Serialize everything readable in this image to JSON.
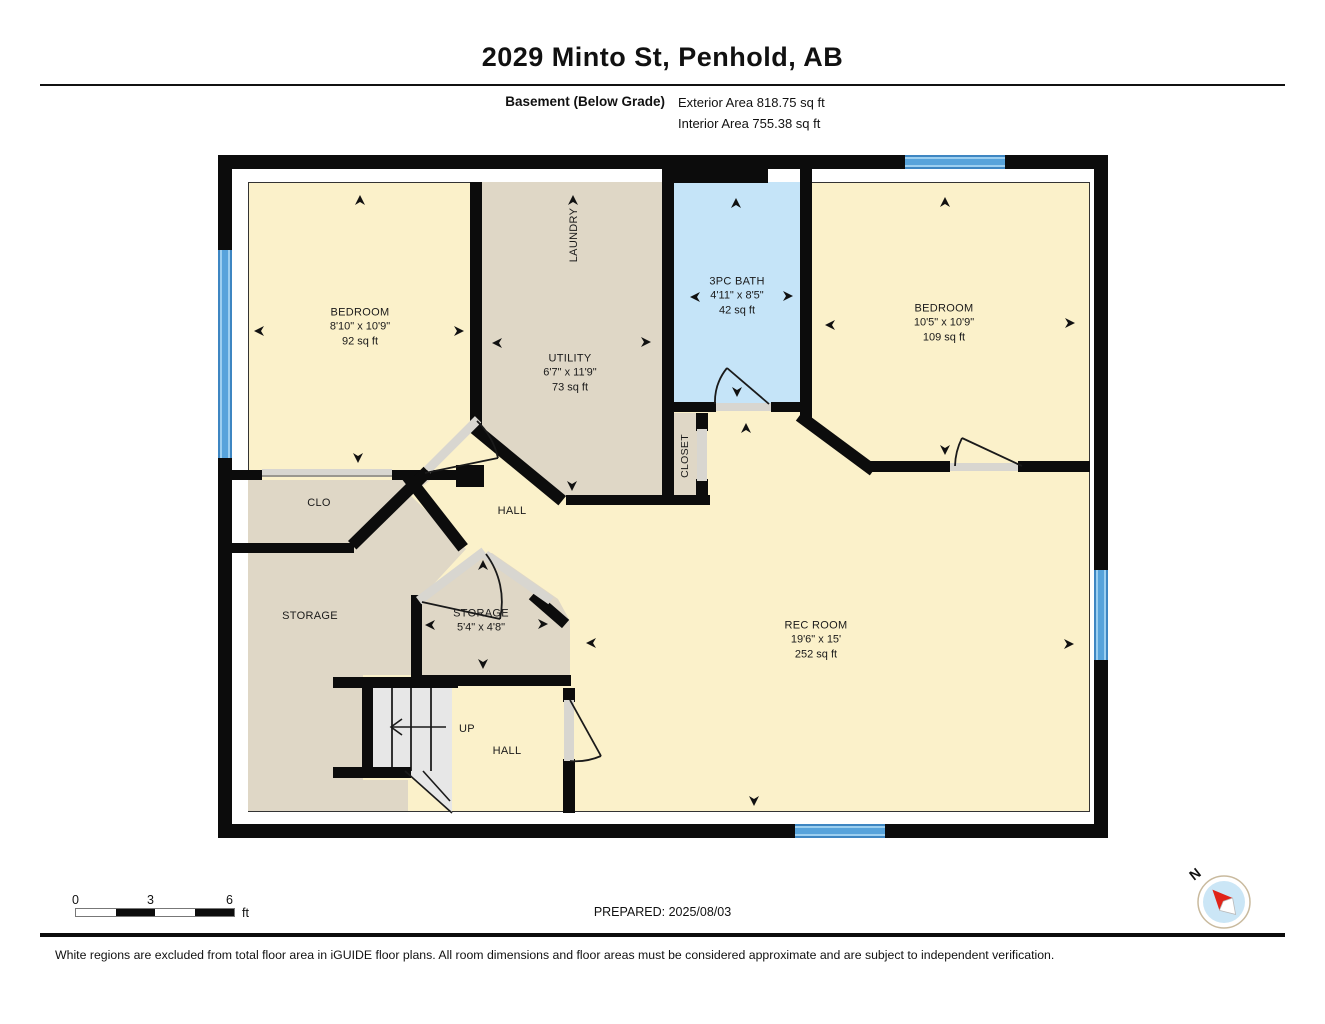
{
  "header": {
    "title": "2029 Minto St, Penhold, AB",
    "floor_label": "Basement (Below Grade)",
    "exterior_area": "Exterior Area 818.75 sq ft",
    "interior_area": "Interior Area 755.38 sq ft"
  },
  "rooms": {
    "bedroom_left": {
      "name": "BEDROOM",
      "dims": "8'10\" x 10'9\"",
      "area": "92 sq ft"
    },
    "laundry": {
      "name": "LAUNDRY"
    },
    "utility": {
      "name": "UTILITY",
      "dims": "6'7\" x 11'9\"",
      "area": "73 sq ft"
    },
    "bath": {
      "name": "3PC BATH",
      "dims": "4'11\" x 8'5\"",
      "area": "42 sq ft"
    },
    "bedroom_right": {
      "name": "BEDROOM",
      "dims": "10'5\" x 10'9\"",
      "area": "109 sq ft"
    },
    "closet": {
      "name": "CLOSET"
    },
    "clo": {
      "name": "CLO"
    },
    "hall": {
      "name": "HALL"
    },
    "storage_left": {
      "name": "STORAGE"
    },
    "storage_mid": {
      "name": "STORAGE",
      "dims": "5'4\" x 4'8\""
    },
    "rec_room": {
      "name": "REC ROOM",
      "dims": "19'6\" x 15'",
      "area": "252 sq ft"
    },
    "stairs": {
      "up_label": "UP"
    },
    "hall_lower": {
      "name": "HALL"
    }
  },
  "scale_bar": {
    "tick_0": "0",
    "tick_3": "3",
    "tick_6": "6",
    "unit": "ft"
  },
  "compass": {
    "north_label": "N"
  },
  "footer": {
    "prepared": "PREPARED: 2025/08/03",
    "disclaimer": "White regions are excluded from total floor area in iGUIDE floor plans. All room dimensions and floor areas must be considered approximate and are subject to independent verification."
  },
  "colors": {
    "wall": "#0c0c0c",
    "room_cream": "#FBF1CA",
    "room_tan": "#DFD7C6",
    "bath_blue": "#C5E4F8",
    "window_blue": "#57A3DB",
    "door_gray": "#D8D6D0",
    "stair_gray": "#E7E7E7"
  }
}
